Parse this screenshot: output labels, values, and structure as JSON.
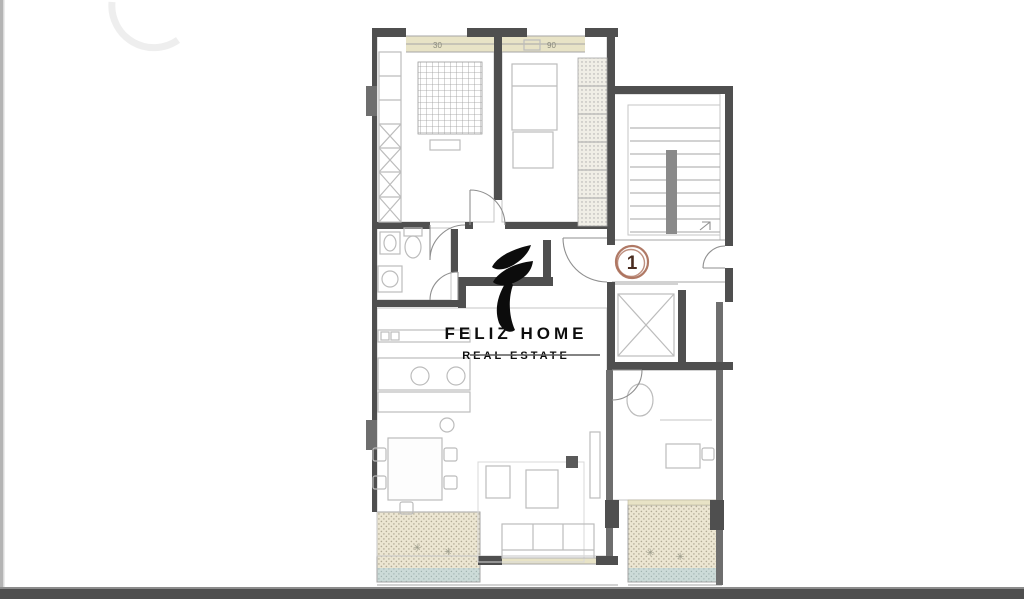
{
  "meta": {
    "kind": "real-estate floor plan screenshot"
  },
  "watermark": {
    "brand": "FELIZ HOME",
    "tagline": "REAL ESTATE",
    "logo_icon": "flame-swoosh-icon"
  },
  "unit_badge": {
    "number": "1"
  },
  "dimension_labels": {
    "top_left_window": "30",
    "top_right_window": "90"
  },
  "balcony_marks": {
    "glyph": "✳"
  },
  "colors": {
    "wall": "#4f4f4f",
    "wallMid": "#6e6e6e",
    "wallSoft": "#8a8a8a",
    "line": "#a6a6a6",
    "lineSoft": "#c6c6c6",
    "furn": "#bcbcbc",
    "cream": "#e8e3c6",
    "balcony": "#ece6d2",
    "balconyDot": "#b2ab96",
    "water": "#ccdbd8",
    "badge": "#a2614a",
    "badgeText": "#4a2c1f",
    "band": "#4e4e4e",
    "edge": "#b4b4b4",
    "ink": "#0d0d0d",
    "dimText": "#8a8a7c"
  }
}
